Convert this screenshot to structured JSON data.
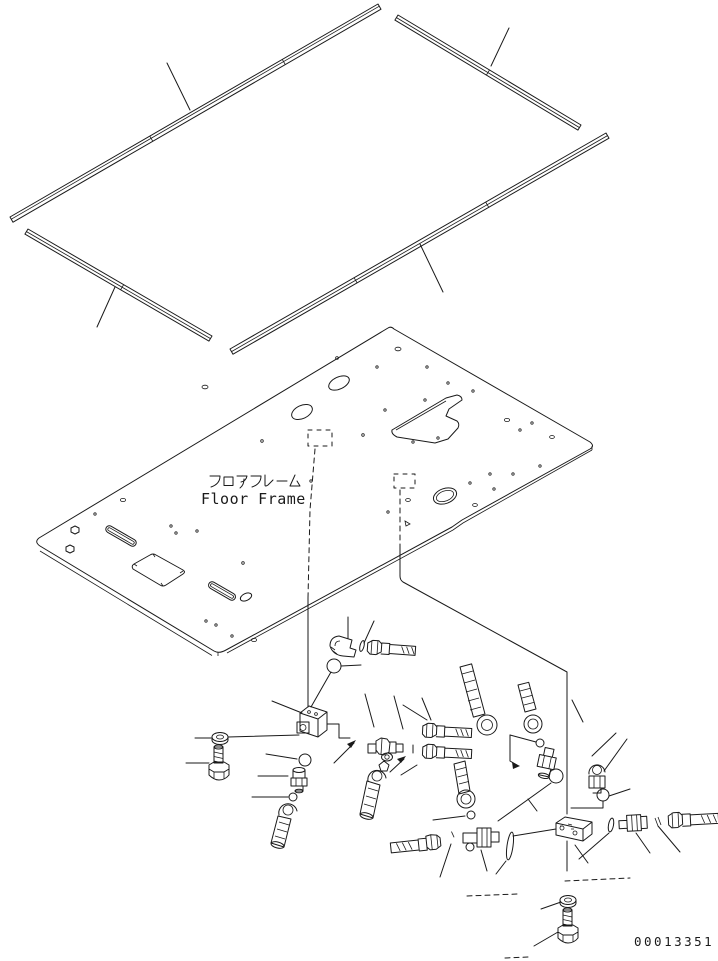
{
  "sheet": {
    "background": "#ffffff",
    "ink": "#1a1a1a",
    "part_number": "00013351"
  },
  "floor_frame": {
    "label_jp": "フロアフレーム",
    "label_en": "Floor Frame"
  },
  "component_names": [
    "weather-strip-rear",
    "weather-strip-front",
    "weather-strip-left",
    "weather-strip-right",
    "floor-frame-plate",
    "manifold-block-1",
    "manifold-block-2",
    "elbow-fitting",
    "straight-connector",
    "tee-fitting",
    "hose-connector",
    "threaded-hose-end",
    "nipple-connector",
    "plug",
    "o-ring",
    "ball",
    "washer",
    "bolt"
  ]
}
